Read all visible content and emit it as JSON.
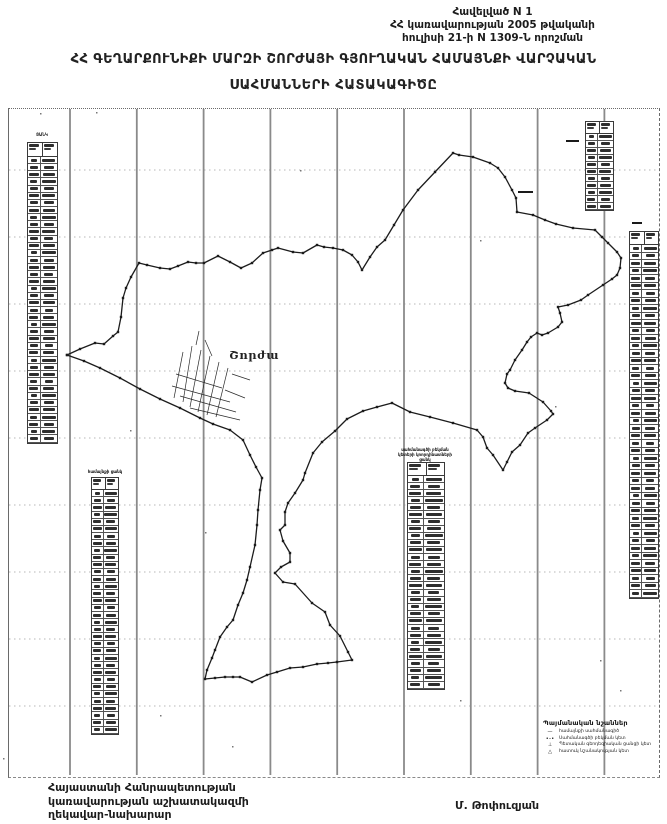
{
  "header": {
    "appendix_lines": [
      "Հավելված N 1",
      "ՀՀ կառավարության 2005 թվականի",
      "հուլիսի 21-ի N 1309-Ն որոշման"
    ],
    "title_line1": "ՀՀ ԳԵՂԱՐՔՈՒՆԻՔԻ ՄԱՐԶԻ ՇՈՐԺԱՅԻ ԳՅՈՒՂԱԿԱՆ ՀԱՄԱՅՆՔԻ ՎԱՐՉԱԿԱՆ",
    "title_line2": "ՍԱՀՄԱՆՆԵՐԻ ՀԱՏԱԿԱԳԻԾԸ"
  },
  "map": {
    "settlement_label": "Շորժա",
    "settlement_label_pos": {
      "x": 229,
      "y": 348
    },
    "frame": {
      "x": 8,
      "y": 108,
      "w": 650,
      "h": 668
    },
    "ink_color": "#1c1c1c",
    "graticule": {
      "color_v": "#8a8a8a",
      "color_h": "#a0a0a0",
      "vx0": 70,
      "vdx": 66.8,
      "vn": 9,
      "vy1": 109,
      "vy2": 775,
      "hy0": 170,
      "hdy": 67,
      "hn": 9,
      "hx1": 9,
      "hx2": 658
    },
    "boundary_points": [
      [
        67,
        355
      ],
      [
        80,
        349
      ],
      [
        95,
        343
      ],
      [
        104,
        344
      ],
      [
        113,
        336
      ],
      [
        118,
        332
      ],
      [
        121,
        317
      ],
      [
        123,
        298
      ],
      [
        126,
        288
      ],
      [
        131,
        277
      ],
      [
        139,
        263
      ],
      [
        147,
        265
      ],
      [
        160,
        268
      ],
      [
        170,
        269
      ],
      [
        178,
        266
      ],
      [
        188,
        262
      ],
      [
        196,
        263
      ],
      [
        204,
        263
      ],
      [
        218,
        256
      ],
      [
        230,
        262
      ],
      [
        241,
        268
      ],
      [
        252,
        263
      ],
      [
        263,
        253
      ],
      [
        272,
        250
      ],
      [
        278,
        248
      ],
      [
        293,
        252
      ],
      [
        303,
        253
      ],
      [
        317,
        245
      ],
      [
        324,
        247
      ],
      [
        333,
        248
      ],
      [
        343,
        250
      ],
      [
        352,
        255
      ],
      [
        358,
        262
      ],
      [
        362,
        270
      ],
      [
        370,
        257
      ],
      [
        377,
        247
      ],
      [
        385,
        240
      ],
      [
        394,
        225
      ],
      [
        403,
        210
      ],
      [
        418,
        190
      ],
      [
        435,
        172
      ],
      [
        453,
        153
      ],
      [
        459,
        155
      ],
      [
        473,
        157
      ],
      [
        490,
        163
      ],
      [
        498,
        168
      ],
      [
        505,
        177
      ],
      [
        512,
        190
      ],
      [
        516,
        198
      ],
      [
        517,
        212
      ],
      [
        533,
        215
      ],
      [
        545,
        220
      ],
      [
        556,
        224
      ],
      [
        573,
        228
      ],
      [
        595,
        230
      ],
      [
        602,
        237
      ],
      [
        608,
        243
      ],
      [
        617,
        252
      ],
      [
        621,
        258
      ],
      [
        620,
        268
      ],
      [
        617,
        275
      ],
      [
        612,
        279
      ],
      [
        603,
        285
      ],
      [
        588,
        295
      ],
      [
        581,
        300
      ],
      [
        568,
        305
      ],
      [
        558,
        307
      ],
      [
        560,
        313
      ],
      [
        562,
        322
      ],
      [
        558,
        327
      ],
      [
        548,
        333
      ],
      [
        542,
        335
      ],
      [
        537,
        333
      ],
      [
        531,
        337
      ],
      [
        527,
        342
      ],
      [
        522,
        350
      ],
      [
        515,
        360
      ],
      [
        510,
        370
      ],
      [
        507,
        374
      ],
      [
        505,
        383
      ],
      [
        508,
        388
      ],
      [
        515,
        391
      ],
      [
        529,
        393
      ],
      [
        543,
        402
      ],
      [
        551,
        411
      ],
      [
        553,
        414
      ],
      [
        547,
        420
      ],
      [
        535,
        428
      ],
      [
        528,
        433
      ],
      [
        520,
        445
      ],
      [
        512,
        452
      ],
      [
        507,
        462
      ],
      [
        503,
        470
      ],
      [
        493,
        455
      ],
      [
        487,
        448
      ],
      [
        483,
        437
      ],
      [
        477,
        430
      ],
      [
        453,
        423
      ],
      [
        430,
        417
      ],
      [
        410,
        412
      ],
      [
        392,
        403
      ],
      [
        377,
        407
      ],
      [
        363,
        411
      ],
      [
        347,
        419
      ],
      [
        335,
        431
      ],
      [
        322,
        442
      ],
      [
        313,
        453
      ],
      [
        305,
        473
      ],
      [
        303,
        480
      ],
      [
        295,
        493
      ],
      [
        288,
        503
      ],
      [
        285,
        512
      ],
      [
        285,
        525
      ],
      [
        280,
        530
      ],
      [
        283,
        541
      ],
      [
        290,
        553
      ],
      [
        290,
        562
      ],
      [
        281,
        567
      ],
      [
        275,
        573
      ],
      [
        283,
        582
      ],
      [
        295,
        584
      ],
      [
        312,
        603
      ],
      [
        325,
        612
      ],
      [
        330,
        625
      ],
      [
        340,
        636
      ],
      [
        348,
        652
      ],
      [
        352,
        660
      ],
      [
        337,
        662
      ],
      [
        328,
        663
      ],
      [
        317,
        664
      ],
      [
        303,
        667
      ],
      [
        290,
        668
      ],
      [
        277,
        672
      ],
      [
        267,
        675
      ],
      [
        252,
        682
      ],
      [
        240,
        677
      ],
      [
        233,
        677
      ],
      [
        225,
        677
      ],
      [
        215,
        678
      ],
      [
        205,
        679
      ],
      [
        207,
        670
      ],
      [
        212,
        658
      ],
      [
        215,
        650
      ],
      [
        220,
        637
      ],
      [
        227,
        627
      ],
      [
        233,
        620
      ],
      [
        238,
        605
      ],
      [
        243,
        593
      ],
      [
        247,
        580
      ],
      [
        250,
        567
      ],
      [
        255,
        545
      ],
      [
        257,
        525
      ],
      [
        258,
        510
      ],
      [
        260,
        490
      ],
      [
        262,
        478
      ],
      [
        256,
        467
      ],
      [
        250,
        455
      ],
      [
        243,
        440
      ],
      [
        230,
        430
      ],
      [
        213,
        424
      ],
      [
        200,
        418
      ],
      [
        180,
        408
      ],
      [
        160,
        399
      ],
      [
        140,
        389
      ],
      [
        120,
        378
      ],
      [
        100,
        368
      ],
      [
        84,
        361
      ],
      [
        67,
        355
      ]
    ],
    "settlement_lines": [
      [
        [
          183,
          352
        ],
        [
          174,
          398
        ]
      ],
      [
        [
          192,
          346
        ],
        [
          183,
          402
        ]
      ],
      [
        [
          201,
          350
        ],
        [
          190,
          407
        ]
      ],
      [
        [
          210,
          356
        ],
        [
          198,
          412
        ]
      ],
      [
        [
          219,
          362
        ],
        [
          207,
          415
        ]
      ],
      [
        [
          228,
          368
        ],
        [
          216,
          417
        ]
      ],
      [
        [
          172,
          386
        ],
        [
          230,
          402
        ]
      ],
      [
        [
          176,
          374
        ],
        [
          222,
          388
        ]
      ],
      [
        [
          180,
          396
        ],
        [
          236,
          412
        ]
      ],
      [
        [
          190,
          408
        ],
        [
          240,
          420
        ]
      ],
      [
        [
          205,
          340
        ],
        [
          212,
          356
        ]
      ],
      [
        [
          225,
          390
        ],
        [
          245,
          398
        ]
      ],
      [
        [
          196,
          345
        ],
        [
          199,
          331
        ]
      ],
      [
        [
          232,
          374
        ],
        [
          250,
          380
        ]
      ]
    ],
    "tables": [
      {
        "name": "left-upper-table",
        "x": 27,
        "y": 142,
        "w": 31,
        "h": 302,
        "rows": 40,
        "header_h": 14,
        "caption": {
          "x": 24,
          "y": 132,
          "w": 36,
          "lines": [
            "ՑԱՆԿ"
          ]
        }
      },
      {
        "name": "left-lower-table",
        "x": 91,
        "y": 477,
        "w": 28,
        "h": 258,
        "rows": 34,
        "header_h": 12,
        "caption": {
          "x": 82,
          "y": 469,
          "w": 46,
          "lines": [
            "համայնքի ցանկ"
          ]
        }
      },
      {
        "name": "mid-bottom-table",
        "x": 407,
        "y": 462,
        "w": 38,
        "h": 228,
        "rows": 30,
        "header_h": 13,
        "caption": {
          "x": 398,
          "y": 447,
          "w": 54,
          "lines": [
            "սահմանագծի բեկման",
            "կետերի կոորդինատների",
            "ցանկ"
          ]
        }
      },
      {
        "name": "top-right-table",
        "x": 585,
        "y": 121,
        "w": 29,
        "h": 90,
        "rows": 11,
        "header_h": 12,
        "caption": null
      },
      {
        "name": "right-long-table",
        "x": 629,
        "y": 231,
        "w": 30,
        "h": 368,
        "rows": 47,
        "header_h": 13,
        "caption": null
      }
    ],
    "marks": [
      {
        "x": 566,
        "y": 140,
        "w": 13
      },
      {
        "x": 632,
        "y": 222,
        "w": 10
      },
      {
        "x": 518,
        "y": 191,
        "w": 15
      }
    ],
    "specks": [
      [
        40,
        113
      ],
      [
        96,
        112
      ],
      [
        300,
        170
      ],
      [
        555,
        406
      ],
      [
        205,
        532
      ],
      [
        600,
        660
      ],
      [
        160,
        715
      ],
      [
        232,
        746
      ],
      [
        460,
        700
      ],
      [
        620,
        690
      ],
      [
        3,
        758
      ],
      [
        130,
        430
      ],
      [
        480,
        240
      ]
    ],
    "legend": {
      "x": 543,
      "y": 719,
      "w": 112,
      "title": "Պայմանական նշաններ",
      "items": [
        {
          "symbol": "—",
          "label": "համայնքի սահմանագիծ"
        },
        {
          "symbol": "•–•",
          "label": "Սահմանագծի բեկման կետ"
        },
        {
          "symbol": "⊥",
          "label": "Պետական գեոդեզիական ցանցի կետ"
        },
        {
          "symbol": "△",
          "label": "հատուկ նշանակության կետ"
        }
      ]
    }
  },
  "footer": {
    "left_lines": [
      "Հայաստանի Հանրապետության",
      "կառավարության աշխատակազմի",
      "ղեկավար-նախարար"
    ],
    "signature": "Մ. Թոփուզյան"
  }
}
